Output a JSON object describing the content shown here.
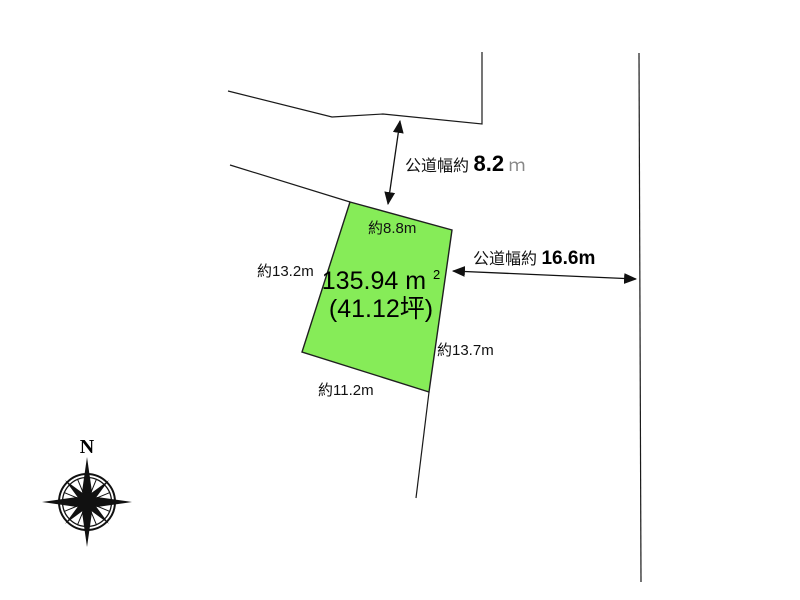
{
  "parcel": {
    "area_value": "135.94",
    "area_unit": "m",
    "area_sup": "2",
    "area_tsubo": "(41.12坪)",
    "edges": {
      "top": "約8.8m",
      "left": "約13.2m",
      "right": "約13.7m",
      "bottom": "約11.2m"
    }
  },
  "roads": {
    "north": {
      "prefix": "公道幅約",
      "value": "8.2",
      "unit": "ｍ"
    },
    "east": {
      "prefix": "公道幅約",
      "value": "16.6m"
    }
  },
  "compass": {
    "label": "N"
  },
  "colors": {
    "parcel_fill": "#86EC58",
    "line": "#1a1a1a"
  }
}
